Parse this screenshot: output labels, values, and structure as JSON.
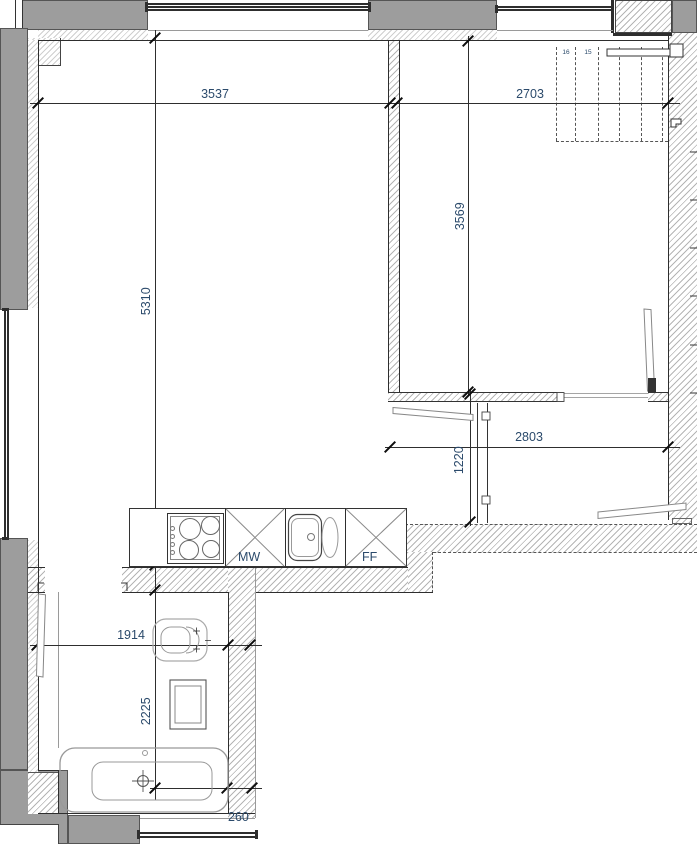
{
  "plan": {
    "type": "apartment-floor-plan",
    "dims": {
      "top_left_width": "3537",
      "top_right_width": "2703",
      "right_room_height": "3569",
      "living_room_height": "5310",
      "hall_width": "2803",
      "corridor_height": "1220",
      "bath_width": "1914",
      "bath_height": "2225",
      "wall_thickness": "260"
    },
    "kitchen": {
      "microwave_label": "MW",
      "fridge_label": "FF"
    },
    "stairs": {
      "steps": [
        "16",
        "15",
        "14",
        "13",
        "12",
        "11"
      ]
    },
    "colors": {
      "wall_gray": "#9d9d9d",
      "dim_text": "#2b4a6b",
      "line": "#2e2e2e"
    }
  }
}
